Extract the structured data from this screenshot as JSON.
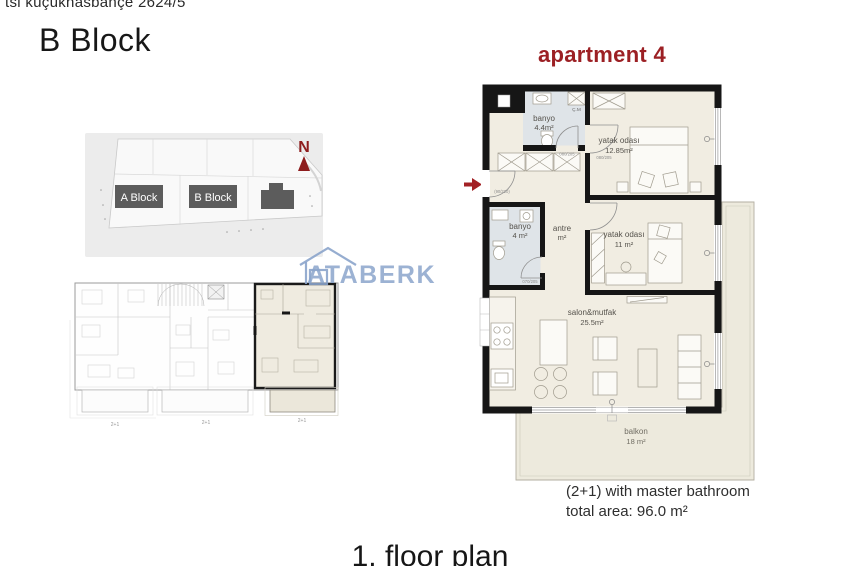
{
  "header": {
    "location_line": "tsi küçükhasbahçe 2624/5",
    "block_title": "B Block"
  },
  "site_plan": {
    "north_label": "N",
    "block_a_label": "A Block",
    "block_b_label": "B Block"
  },
  "overview_plan": {
    "unit_labels": [
      "2+1",
      "2+1",
      "2+1"
    ]
  },
  "watermark": {
    "brand": "ATABERK"
  },
  "apartment": {
    "title": "apartment 4",
    "rooms": {
      "banyo_small": {
        "name": "banyo",
        "area": "4.4m²"
      },
      "bedroom1": {
        "name": "yatak odası",
        "area": "12.85m²"
      },
      "banyo_master": {
        "name": "banyo",
        "area": "4 m²"
      },
      "antre": {
        "name": "antre",
        "area": "m²"
      },
      "bedroom2": {
        "name": "yatak odası",
        "area": "11 m²"
      },
      "salon": {
        "name": "salon&mutfak",
        "area": "25.5m²"
      },
      "balkon": {
        "name": "balkon",
        "area": "18 m²"
      }
    },
    "closet_label": "Ç.M",
    "door_labels": {
      "entrance": "(90/220)",
      "banyo_small": "080/205",
      "bedroom1": "080/205",
      "banyo_master": "070/205"
    },
    "summary": {
      "line1": "(2+1) with master bathroom",
      "line2": "total area: 96.0 m²"
    }
  },
  "footer": {
    "plan_title": "1. floor plan"
  },
  "colors": {
    "accent_red": "#9c2024",
    "north_red": "#8e1d1e",
    "watermark_blue": "#8ba4cb",
    "floor_beige": "#f1ede2",
    "floor_bath": "#dfe4e8",
    "terrace_beige": "#edeadd",
    "wall_black": "#161616",
    "site_block_gray": "#5c5c5c"
  }
}
